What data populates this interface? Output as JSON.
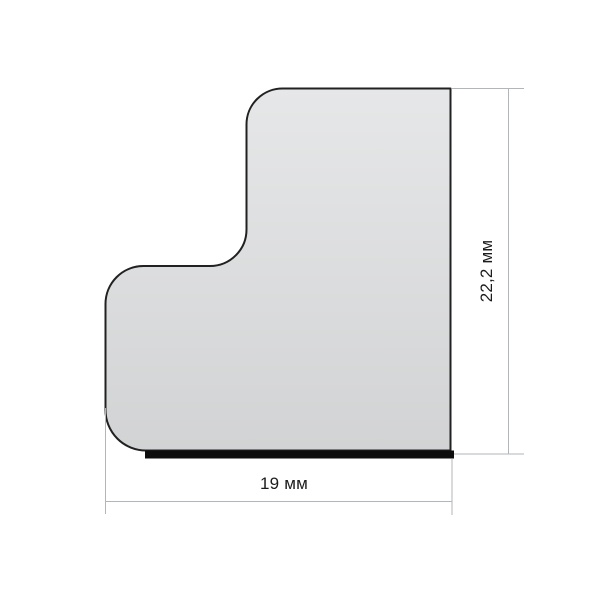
{
  "drawing": {
    "type": "profile-cross-section-diagram",
    "shape": "L-shaped corner profile with rounded corners and adhesive strip on bottom edge",
    "width_label": "19 мм",
    "height_label": "22,2 мм",
    "width_value_mm": 19,
    "height_value_mm": 22.2,
    "units": "мм"
  },
  "colors": {
    "background": "#ffffff",
    "fill_top": "#e6e7e8",
    "fill_bottom": "#d2d3d4",
    "outline": "#212121",
    "strip": "#0d0d0d",
    "dim_line": "#b3b6b8",
    "label_text": "#1c1c1c"
  }
}
